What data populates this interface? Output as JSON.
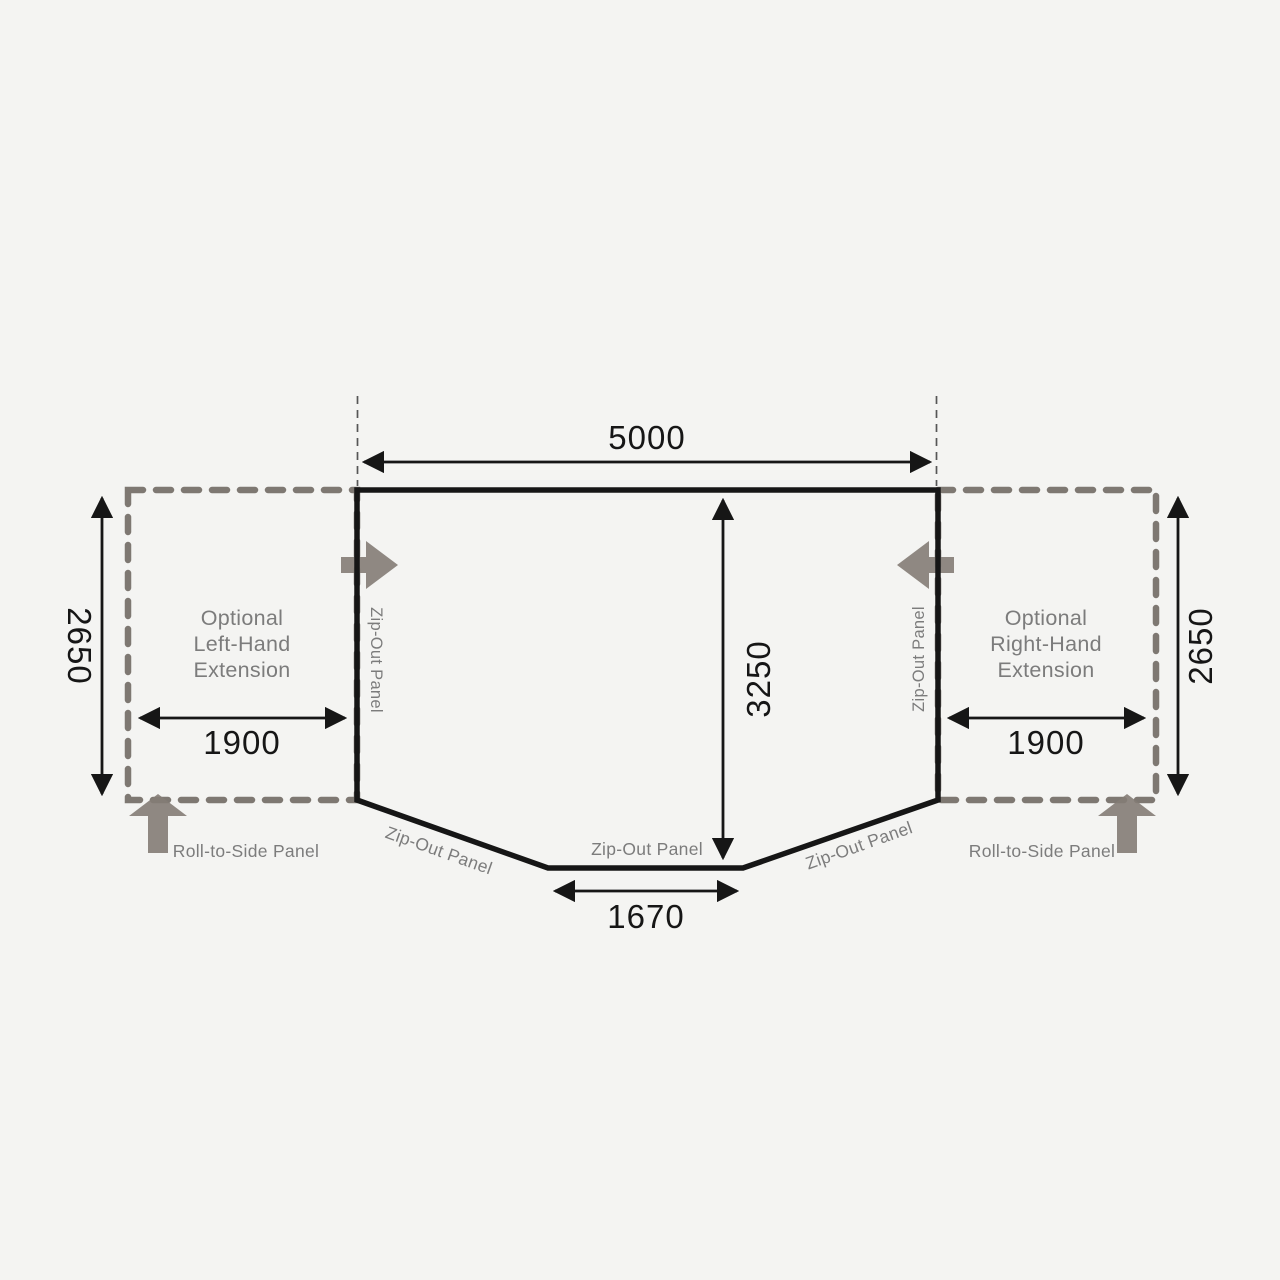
{
  "title": "Awning floor plan with optional extensions",
  "dimensions": {
    "total_width_mm": "5000",
    "depth_mm": "3250",
    "front_width_mm": "1670",
    "extension_width_left_mm": "1900",
    "extension_width_right_mm": "1900",
    "extension_depth_left_mm": "2650",
    "extension_depth_right_mm": "2650"
  },
  "labels": {
    "left_extension_line1": "Optional",
    "left_extension_line2": "Left-Hand",
    "left_extension_line3": "Extension",
    "right_extension_line1": "Optional",
    "right_extension_line2": "Right-Hand",
    "right_extension_line3": "Extension",
    "zip_out_panel": "Zip-Out Panel",
    "roll_to_side_panel": "Roll-to-Side Panel"
  },
  "colors": {
    "background": "#f4f4f2",
    "outline": "#161616",
    "dashed_gray": "#7e7872",
    "arrow_gray": "#847c75",
    "label_gray": "#7c7c7c",
    "thin_dash": "#565656"
  }
}
